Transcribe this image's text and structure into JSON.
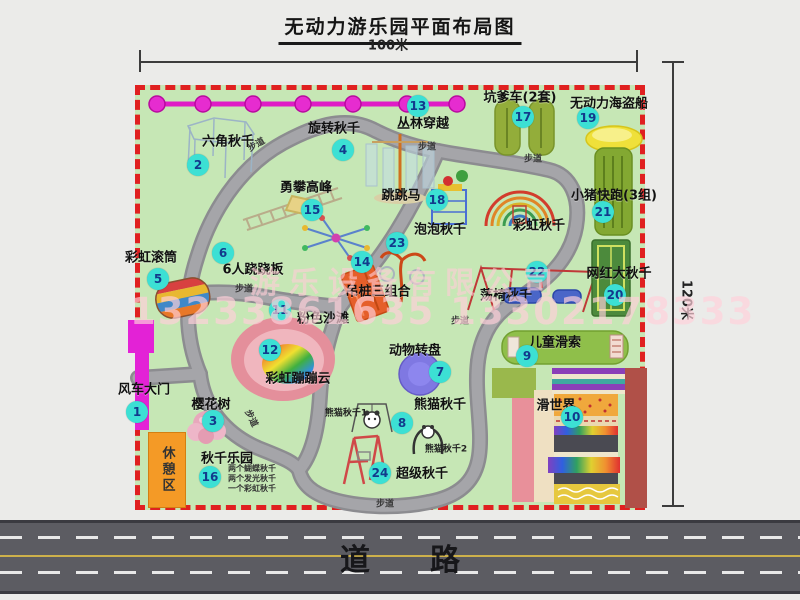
{
  "title": "无动力游乐园平面布局图",
  "dimension_width": "100米",
  "dimension_height": "120米",
  "road": "道　　路",
  "walkway": "步道",
  "rest_area": "休憩区",
  "watermark": {
    "company": "游乐设备有限公司",
    "phone": "13233861635 13302178333"
  },
  "colors": {
    "border_red": "#e02020",
    "park_green": "#c6e7b5",
    "path_gray": "#a5a5a9",
    "badge_cyan": "#3ce0d4",
    "badge_text_navy": "#123a8c",
    "zipline_magenta": "#df1cc6",
    "gate_magenta": "#e322d6",
    "rest_area_orange": "#f49a26",
    "road_gray": "#5c5c62"
  },
  "attractions": [
    {
      "num": "1",
      "name": "风车大门"
    },
    {
      "num": "2",
      "name": "六角秋千"
    },
    {
      "num": "3",
      "name": "樱花树"
    },
    {
      "num": "4",
      "name": "旋转秋千"
    },
    {
      "num": "5",
      "name": "彩虹滚筒"
    },
    {
      "num": "6",
      "name": "6人跷跷板"
    },
    {
      "num": "7",
      "name": "动物转盘"
    },
    {
      "num": "8",
      "name": "熊猫秋千"
    },
    {
      "num": "9",
      "name": "儿童滑索"
    },
    {
      "num": "10",
      "name": "滑世界"
    },
    {
      "num": "11",
      "name": "粉色沙滩"
    },
    {
      "num": "12",
      "name": "彩虹蹦蹦云"
    },
    {
      "num": "13",
      "name": "丛林穿越"
    },
    {
      "num": "14",
      "name": "吊桩三组合"
    },
    {
      "num": "15",
      "name": "勇攀高峰"
    },
    {
      "num": "16",
      "name": "秋千乐园",
      "notes": [
        "两个蝴蝶秋千",
        "两个发光秋千",
        "一个彩虹秋千"
      ]
    },
    {
      "num": "17",
      "name": "坑爹车(2套)"
    },
    {
      "num": "18",
      "name": "跳跳马"
    },
    {
      "num": "19",
      "name": "无动力海盗船"
    },
    {
      "num": "20",
      "name": "网红大秋千"
    },
    {
      "num": "21",
      "name": "小猪快跑(3组)"
    },
    {
      "num": "22",
      "name": "荡椅秋千"
    },
    {
      "num": "23",
      "name": "泡泡秋千"
    },
    {
      "num": "24",
      "name": "超级秋千"
    }
  ],
  "extra_labels": {
    "rainbow_swing": "彩虹秋千",
    "panda_swing_1": "熊猫秋千1",
    "panda_swing_2": "熊猫秋千2"
  }
}
